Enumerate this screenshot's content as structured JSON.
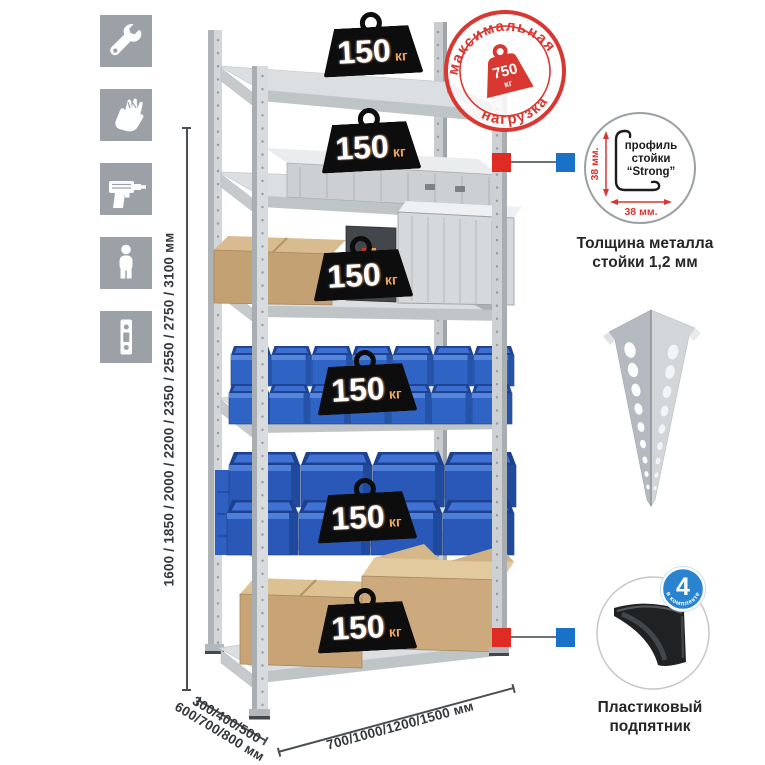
{
  "palette": {
    "accent_red": "#d93832",
    "accent_blue": "#1a72c8",
    "metal": "#d3d7da",
    "bin_blue": "#2f63c4",
    "tile_gray": "#9ba1a6"
  },
  "left_icons": {
    "items": [
      {
        "name": "wrench"
      },
      {
        "name": "gloves"
      },
      {
        "name": "drill"
      },
      {
        "name": "person"
      },
      {
        "name": "post-strip"
      }
    ]
  },
  "dimensions": {
    "height_label": "1600 / 1850 / 2000 / 2200 / 2350 / 2550 / 2750 / 3100 мм",
    "depth_label_line1": "300/400/500",
    "depth_label_line2": "600/700/800 мм",
    "width_label": "700/1000/1200/1500 мм"
  },
  "rack": {
    "shelf_count": 6,
    "shelves": [
      {
        "load_value": "150",
        "load_unit": "кг"
      },
      {
        "load_value": "150",
        "load_unit": "кг"
      },
      {
        "load_value": "150",
        "load_unit": "кг"
      },
      {
        "load_value": "150",
        "load_unit": "кг"
      },
      {
        "load_value": "150",
        "load_unit": "кг"
      },
      {
        "load_value": "150",
        "load_unit": "кг"
      }
    ]
  },
  "max_load_stamp": {
    "arc_top": "максимальная",
    "arc_bottom": "нагрузка",
    "value": "750",
    "unit": "кг"
  },
  "profile_detail": {
    "dim_vertical": "38 мм.",
    "dim_horizontal": "38 мм.",
    "label_line1": "профиль",
    "label_line2": "стойки",
    "label_line3": "“Strong”",
    "caption_line1": "Толщина металла",
    "caption_line2": "стойки 1,2 мм"
  },
  "foot_detail": {
    "badge_value": "4",
    "badge_text": "в комплекте",
    "caption_line1": "Пластиковый",
    "caption_line2": "подпятник"
  }
}
